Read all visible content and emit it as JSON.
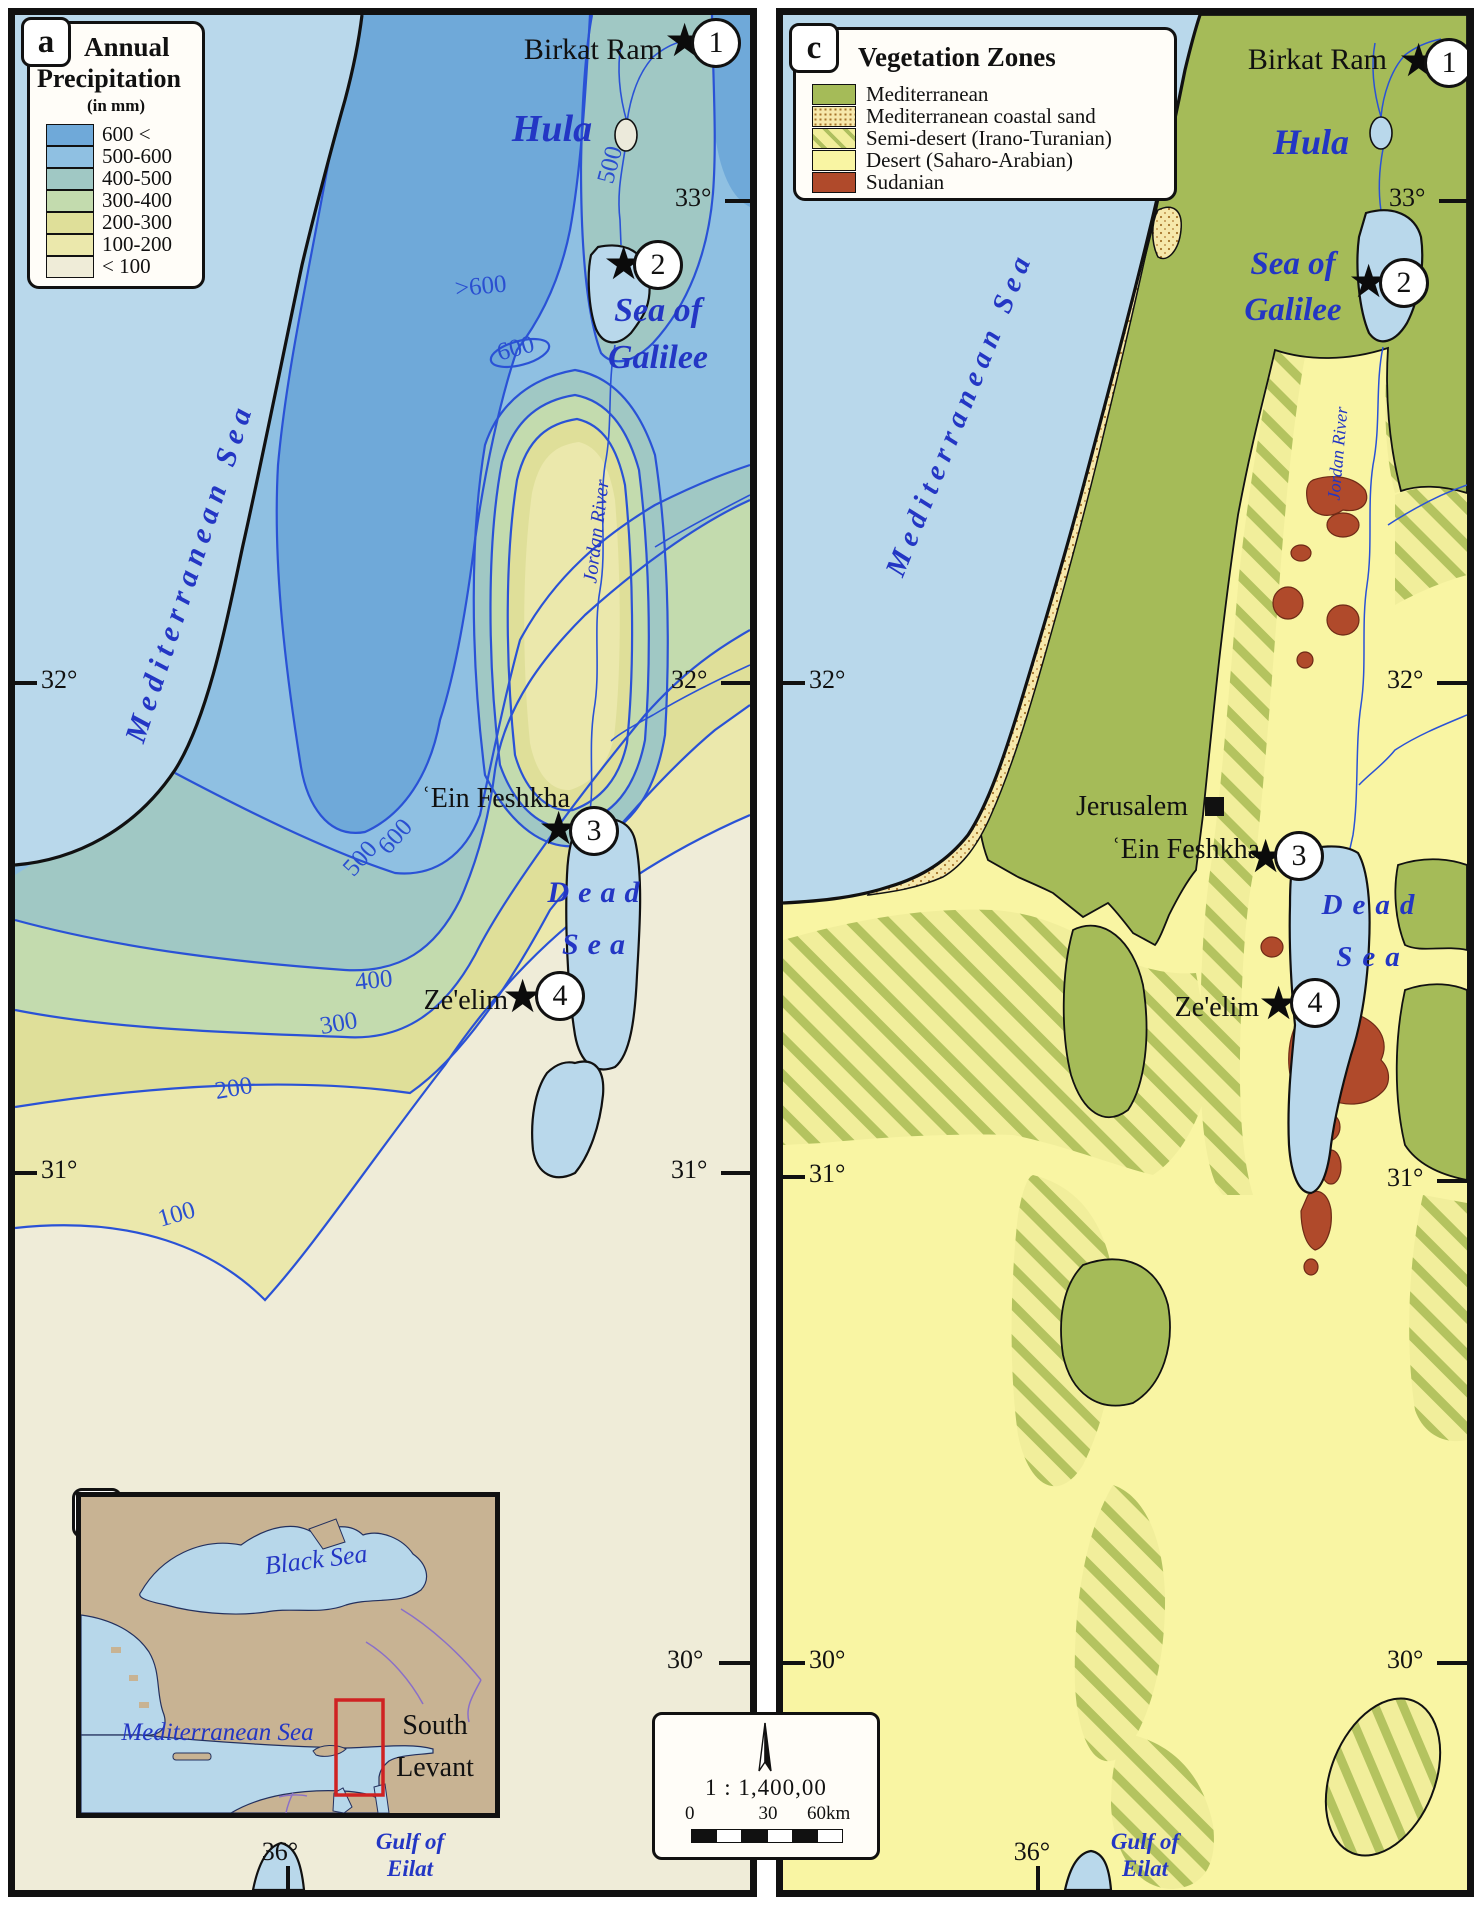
{
  "sites": {
    "s1": "Birkat Ram",
    "s2": "ʿEin Feshkha",
    "s3": "Ze'elim",
    "jerusalem": "Jerusalem",
    "n1": "1",
    "n2": "2",
    "n3": "3",
    "n4": "4"
  },
  "ticks": {
    "lat33": "33°",
    "lat32": "32°",
    "lat31": "31°",
    "lat30": "30°",
    "lon36": "36°"
  },
  "scale": {
    "ratio": "1 : 1,400,00",
    "t0": "0",
    "t30": "30",
    "t60": "60km"
  },
  "panels": {
    "a": {
      "tab": "a",
      "legend": {
        "title1": "Annual",
        "title2": "Precipitation",
        "subtitle": "(in mm)",
        "items": [
          {
            "label": "600 <",
            "color": "#6fa9d9"
          },
          {
            "label": "500-600",
            "color": "#8fc0e2"
          },
          {
            "label": "400-500",
            "color": "#a0c8c4"
          },
          {
            "label": "300-400",
            "color": "#c3dbae"
          },
          {
            "label": "200-300",
            "color": "#dfdf99"
          },
          {
            "label": "100-200",
            "color": "#ebe8ac"
          },
          {
            "label": "< 100",
            "color": "#efecd8"
          }
        ]
      },
      "contours": {
        "hula": "500",
        "west_galilee": ">600",
        "closed": "600",
        "rift_600": "600",
        "rift_500": "500",
        "c400": "400",
        "c300": "300",
        "c200": "200",
        "c100": "100"
      },
      "labels": {
        "sea": "Mediterranean Sea",
        "hula": "Hula",
        "galilee_1": "Sea of",
        "galilee_2": "Galilee",
        "dead_1": "Dead",
        "dead_2": "Sea",
        "jordan": "Jordan River",
        "gulf_1": "Gulf of",
        "gulf_2": "Eilat"
      }
    },
    "b": {
      "tab": "b",
      "labels": {
        "black_sea": "Black Sea",
        "med_sea": "Mediterranean Sea",
        "region_1": "South",
        "region_2": "Levant"
      }
    },
    "c": {
      "tab": "c",
      "legend": {
        "title": "Vegetation Zones",
        "items": [
          {
            "label": "Mediterranean",
            "color": "#a5bb58"
          },
          {
            "label": "Mediterranean coastal sand",
            "color": "#f6e8ab"
          },
          {
            "label": "Semi-desert (Irano-Turanian)",
            "color": "#f1ee9b"
          },
          {
            "label": "Desert (Saharo-Arabian)",
            "color": "#f9f5a3"
          },
          {
            "label": "Sudanian",
            "color": "#b04a2b"
          }
        ]
      },
      "labels": {
        "sea": "Mediterranean Sea",
        "hula": "Hula",
        "galilee_1": "Sea of",
        "galilee_2": "Galilee",
        "dead_1": "Dead",
        "dead_2": "Sea",
        "jordan": "Jordan River",
        "gulf_1": "Gulf of",
        "gulf_2": "Eilat"
      }
    }
  }
}
